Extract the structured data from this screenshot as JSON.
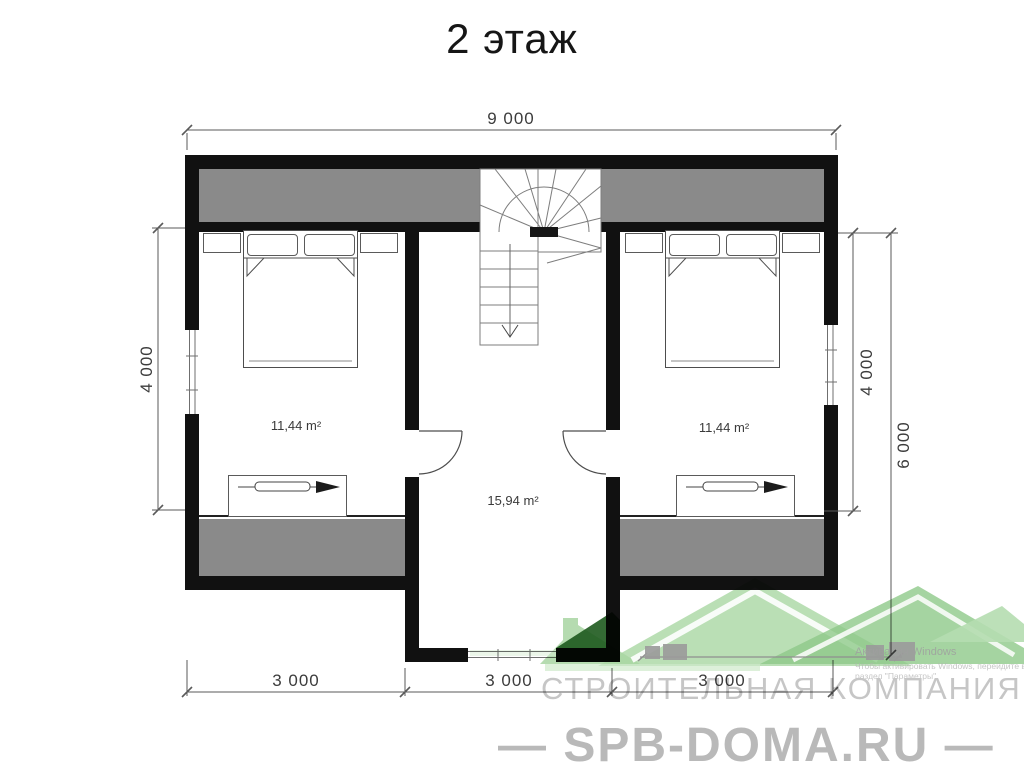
{
  "title": "2 этаж",
  "dimensions": {
    "top": "9 000",
    "left": "4 000",
    "right_inner": "4 000",
    "right_outer": "6 000",
    "bottom": [
      "3 000",
      "3 000",
      "3 000"
    ]
  },
  "rooms": {
    "left_bedroom": {
      "area": "11,44 m²"
    },
    "center_hall": {
      "area": "15,94 m²"
    },
    "right_bedroom": {
      "area": "11,44 m²"
    }
  },
  "watermark": {
    "company": "СТРОИТЕЛЬНАЯ КОМПАНИЯ",
    "website": "— SPB-DOMA.RU —",
    "activation": {
      "line1": "Активация Windows",
      "line2": "Чтобы активировать Windows, перейдите в",
      "line3": "раздел \"Параметры\"."
    }
  },
  "colors": {
    "wall": "#111111",
    "attic_gray": "#8a8a8a",
    "dim_text": "#3c3c3c",
    "watermark_gray": "#c6c6c6",
    "logo_green": "#9ccf96",
    "logo_green_light": "#b5ddb0",
    "logo_green_dark": "#1e5a1e",
    "logo_house_gray": "#9b9b9b"
  }
}
